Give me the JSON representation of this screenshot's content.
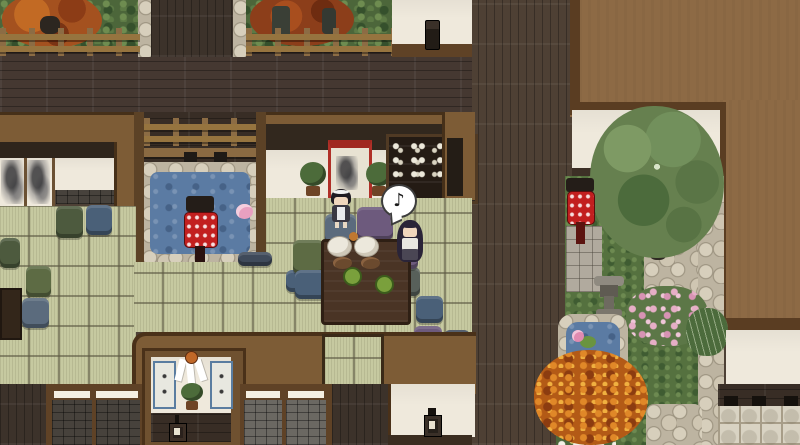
{
  "scene": {
    "title": "top-down japanese house and garden scene",
    "speech_bubble": {
      "glyph": "♪"
    },
    "characters": [
      {
        "id": "maid",
        "desc": "standing maid, black hair, white headband, dark dress with white apron"
      },
      {
        "id": "seated-girl",
        "desc": "girl with long dark hair seated on purple cushion, singing"
      }
    ],
    "objects": [
      "low dining table with rice bowls, plates and green tea cups",
      "floor cushions (olive, blue, purple, navy)",
      "courtyard pond with red lantern and floating blossom",
      "hanging scroll and sake cabinet on rear wall",
      "bonsai plants",
      "shrine alcove with paper streamers, calligraphy scrolls and bonsai",
      "garden with large tree, red lantern, stone lantern, pond with lily, flower beds, autumn bush, stone path"
    ],
    "palette": {
      "deck_wood": "#453831",
      "plank_wall": "#4e4034",
      "roof_brown": "#8d6a45",
      "roof_frame": "#5a3d22",
      "trim_brown": "#7d5c36",
      "tatami": "#c6c9a0",
      "water": "#5b7ba3",
      "lantern_red": "#c21f1f",
      "hedge_green": "#4c663a",
      "white_wall": "#efe9dc",
      "stone": "#bdb4a1",
      "autumn_orange": "#c06018",
      "table_wood": "#4a3425",
      "cushion_olive": "#5d6b44",
      "cushion_blue": "#4a6078",
      "cushion_purple": "#6d5a7d"
    }
  }
}
